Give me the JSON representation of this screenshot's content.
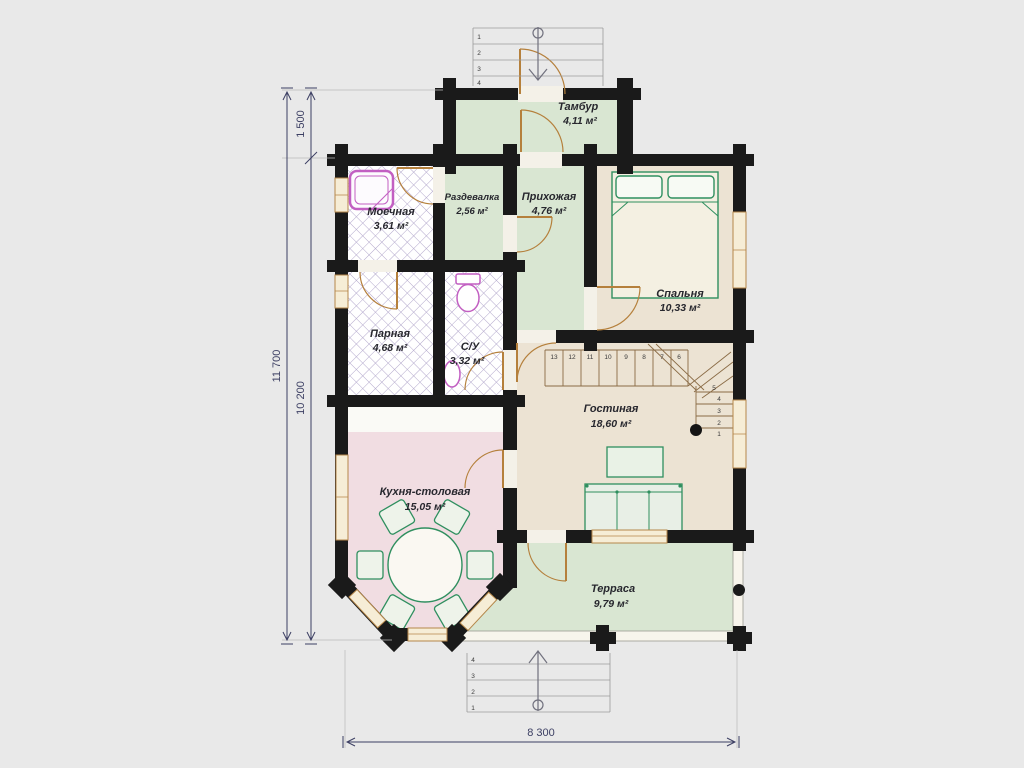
{
  "rooms": [
    {
      "name": "Тамбур",
      "area": "4,11 м²"
    },
    {
      "name": "Раздевалка",
      "area": "2,56 м²"
    },
    {
      "name": "Прихожая",
      "area": "4,76 м²"
    },
    {
      "name": "Спальня",
      "area": "10,33 м²"
    },
    {
      "name": "Моечная",
      "area": "3,61 м²"
    },
    {
      "name": "Парная",
      "area": "4,68 м²"
    },
    {
      "name": "С/У",
      "area": "3,32 м²"
    },
    {
      "name": "Гостиная",
      "area": "18,60 м²"
    },
    {
      "name": "Кухня-столовая",
      "area": "15,05 м²"
    },
    {
      "name": "Терраса",
      "area": "9,79 м²"
    }
  ],
  "dimensions": {
    "left_outer": "11 700",
    "left_inner_top": "1 500",
    "left_inner_bottom": "10 200",
    "bottom": "8 300"
  },
  "stairs": {
    "top_run": [
      "13",
      "12",
      "11",
      "10",
      "9",
      "8",
      "7",
      "6"
    ],
    "right_run": [
      "5",
      "4",
      "3",
      "2",
      "1"
    ]
  },
  "entry_top": {
    "steps": [
      "1",
      "2",
      "3",
      "4"
    ]
  },
  "entry_bottom": {
    "steps": [
      "4",
      "3",
      "2",
      "1"
    ]
  },
  "colors": {
    "background": "#e9e9e9",
    "wall": "#1a1a1a",
    "room_green": "#d9e6d2",
    "room_beige": "#ece3d3",
    "room_pink": "#f1dde2",
    "hatch": "#b3a8cc",
    "window_fill": "#f6edd6",
    "window_frame": "#b5874a",
    "door": "#b5803c",
    "furniture": "#2f8f5f",
    "sanitary": "#c25fc2",
    "dimension": "#3c3f63"
  }
}
